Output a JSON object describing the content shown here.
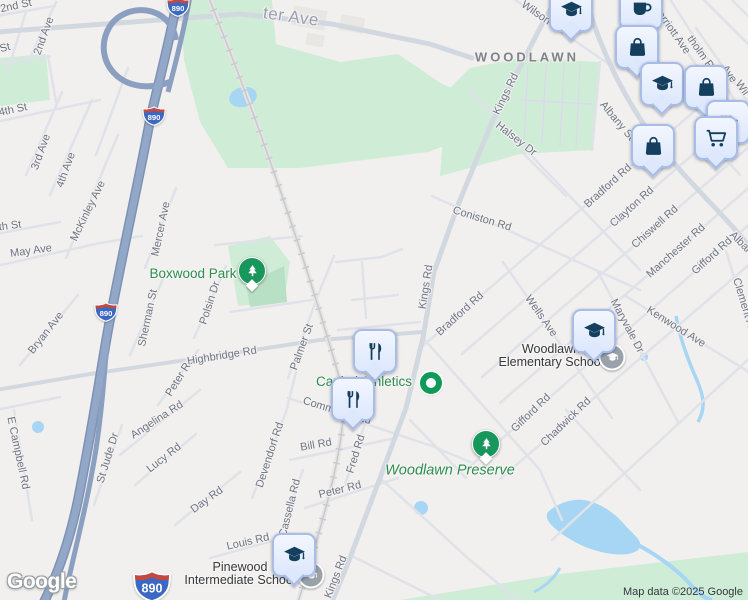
{
  "map": {
    "area_label": "WOODLAWN",
    "logo": "Google",
    "attribution": "Map data ©2025 Google",
    "colors": {
      "background": "#f2f0ee",
      "park_green": "#cfecd6",
      "water_blue": "#a6d6f3",
      "highway_blue": "#8ba0c0",
      "road_gray": "#dfe2e8",
      "marker_bubble": "#dde8fc",
      "marker_glyph": "#143f5e",
      "tree_pin_green": "#17975c",
      "poi_label_green": "#2d8e52",
      "street_label_gray": "#6d7585"
    },
    "poi_labels": [
      {
        "text": "Boxwood Park",
        "x": 193,
        "y": 274,
        "type": "park"
      },
      {
        "text": "Capital Athletics",
        "x": 364,
        "y": 382,
        "type": "park"
      },
      {
        "text": "Woodlawn Preserve",
        "x": 450,
        "y": 471,
        "type": "preserve"
      },
      {
        "lines": [
          "Woodlawn",
          "Elementary School"
        ],
        "x": 551,
        "y": 356,
        "type": "school"
      },
      {
        "lines": [
          "Pinewood",
          "Intermediate School"
        ],
        "x": 240,
        "y": 574,
        "type": "school"
      }
    ],
    "street_labels": [
      {
        "text": "ter Ave",
        "x": 291,
        "y": 17,
        "r": 8,
        "cls": "big"
      },
      {
        "text": "2nd St",
        "x": 16,
        "y": 6,
        "r": -12
      },
      {
        "text": "St",
        "x": 5,
        "y": 48,
        "r": -15
      },
      {
        "text": "2nd Ave",
        "x": 44,
        "y": 36,
        "r": -70
      },
      {
        "text": "4th St",
        "x": 13,
        "y": 110,
        "r": -12
      },
      {
        "text": "3rd Ave",
        "x": 41,
        "y": 152,
        "r": -70
      },
      {
        "text": "4th Ave",
        "x": 66,
        "y": 170,
        "r": -70
      },
      {
        "text": "th St",
        "x": 10,
        "y": 226,
        "r": -8
      },
      {
        "text": "May Ave",
        "x": 31,
        "y": 251,
        "r": -8
      },
      {
        "text": "McKinley Ave",
        "x": 88,
        "y": 211,
        "r": -64
      },
      {
        "text": "Mercer Ave",
        "x": 161,
        "y": 229,
        "r": -78
      },
      {
        "text": "Sherman St",
        "x": 148,
        "y": 318,
        "r": -78
      },
      {
        "text": "Polsin Dr",
        "x": 210,
        "y": 303,
        "r": -72
      },
      {
        "text": "Bryan Ave",
        "x": 46,
        "y": 333,
        "r": -52
      },
      {
        "text": "E Campbell Rd",
        "x": 18,
        "y": 453,
        "r": 78
      },
      {
        "text": "St Jude Dr",
        "x": 108,
        "y": 458,
        "r": -73
      },
      {
        "text": "Lucy Rd",
        "x": 164,
        "y": 458,
        "r": -38
      },
      {
        "text": "Angelina Rd",
        "x": 157,
        "y": 420,
        "r": -33
      },
      {
        "text": "Peter Rd",
        "x": 180,
        "y": 377,
        "r": -58
      },
      {
        "text": "Day Rd",
        "x": 207,
        "y": 500,
        "r": -36
      },
      {
        "text": "Highbridge Rd",
        "x": 222,
        "y": 356,
        "r": -9
      },
      {
        "text": "Louis Rd",
        "x": 248,
        "y": 542,
        "r": -13
      },
      {
        "text": "Devendorf Rd",
        "x": 270,
        "y": 455,
        "r": -72
      },
      {
        "text": "Cassella Rd",
        "x": 290,
        "y": 508,
        "r": -76
      },
      {
        "text": "Bill Rd",
        "x": 316,
        "y": 445,
        "r": -10
      },
      {
        "text": "Fred Rd",
        "x": 356,
        "y": 454,
        "r": -73
      },
      {
        "text": "Peter Rd",
        "x": 340,
        "y": 490,
        "r": -14
      },
      {
        "text": "Commerce Rd",
        "x": 337,
        "y": 411,
        "r": 17
      },
      {
        "text": "Palmer St",
        "x": 302,
        "y": 347,
        "r": -70
      },
      {
        "text": "Kings Rd",
        "x": 426,
        "y": 287,
        "r": -81
      },
      {
        "text": "Kings Rd",
        "x": 336,
        "y": 577,
        "r": -69
      },
      {
        "text": "Kings Rd",
        "x": 506,
        "y": 94,
        "r": -64
      },
      {
        "text": "Bradford Rd",
        "x": 460,
        "y": 314,
        "r": -42
      },
      {
        "text": "Bradford Rd",
        "x": 608,
        "y": 186,
        "r": -42
      },
      {
        "text": "Clayton Rd",
        "x": 632,
        "y": 207,
        "r": -42
      },
      {
        "text": "Chiswell Rd",
        "x": 655,
        "y": 227,
        "r": -42
      },
      {
        "text": "Manchester Rd",
        "x": 676,
        "y": 251,
        "r": -42
      },
      {
        "text": "Gifford Rd",
        "x": 712,
        "y": 256,
        "r": -42
      },
      {
        "text": "Gifford Rd",
        "x": 531,
        "y": 413,
        "r": -44
      },
      {
        "text": "Chadwick Rd",
        "x": 566,
        "y": 422,
        "r": -44
      },
      {
        "text": "Coniston Rd",
        "x": 482,
        "y": 219,
        "r": 17
      },
      {
        "text": "Halsey Dr",
        "x": 516,
        "y": 139,
        "r": 38
      },
      {
        "text": "Wells Ave",
        "x": 541,
        "y": 316,
        "r": 55
      },
      {
        "text": "Maryvale Dr",
        "x": 627,
        "y": 326,
        "r": 62
      },
      {
        "text": "Kenwood Ave",
        "x": 676,
        "y": 327,
        "r": 32
      },
      {
        "text": "Albany St",
        "x": 617,
        "y": 121,
        "r": 50
      },
      {
        "text": "Albany St",
        "x": 748,
        "y": 250,
        "r": 45
      },
      {
        "text": "Clement Ave",
        "x": 745,
        "y": 308,
        "r": 73
      },
      {
        "text": "Wilson",
        "x": 536,
        "y": 13,
        "r": 35
      },
      {
        "text": "Marriott Ave",
        "x": 671,
        "y": 29,
        "r": 55
      },
      {
        "text": "tholm Rd",
        "x": 702,
        "y": 55,
        "r": 55
      },
      {
        "text": "Ave",
        "x": 729,
        "y": 74,
        "r": 55
      },
      {
        "text": "Wil",
        "x": 742,
        "y": 88,
        "r": 55
      }
    ],
    "shields": [
      {
        "label": "890",
        "x": 178,
        "y": 7
      },
      {
        "label": "890",
        "x": 154,
        "y": 116
      },
      {
        "label": "890",
        "x": 106,
        "y": 312
      },
      {
        "label": "890",
        "x": 152,
        "y": 586,
        "large": true
      }
    ],
    "markers": [
      {
        "icon": "graduation-cap",
        "x": 571,
        "y": 10
      },
      {
        "icon": "coffee-cup",
        "x": 641,
        "y": 8
      },
      {
        "icon": "shopping-bag",
        "x": 637,
        "y": 47
      },
      {
        "icon": "graduation-cap",
        "x": 662,
        "y": 84
      },
      {
        "icon": "shopping-bag",
        "x": 706,
        "y": 87
      },
      {
        "icon": "grocery",
        "x": 728,
        "y": 122
      },
      {
        "icon": "shopping-cart",
        "x": 716,
        "y": 138
      },
      {
        "icon": "shopping-bag",
        "x": 653,
        "y": 146
      },
      {
        "icon": "restaurant",
        "x": 375,
        "y": 351
      },
      {
        "icon": "restaurant",
        "x": 353,
        "y": 399
      },
      {
        "icon": "graduation-cap",
        "x": 594,
        "y": 331
      },
      {
        "icon": "graduation-cap",
        "x": 294,
        "y": 555
      }
    ],
    "small_markers": [
      {
        "icon": "school-dot",
        "x": 612,
        "y": 357
      },
      {
        "icon": "school-dot",
        "x": 311,
        "y": 575
      },
      {
        "icon": "park-dot",
        "x": 431,
        "y": 383
      }
    ],
    "tree_pins": [
      {
        "x": 252,
        "y": 271
      },
      {
        "x": 486,
        "y": 444
      }
    ]
  }
}
